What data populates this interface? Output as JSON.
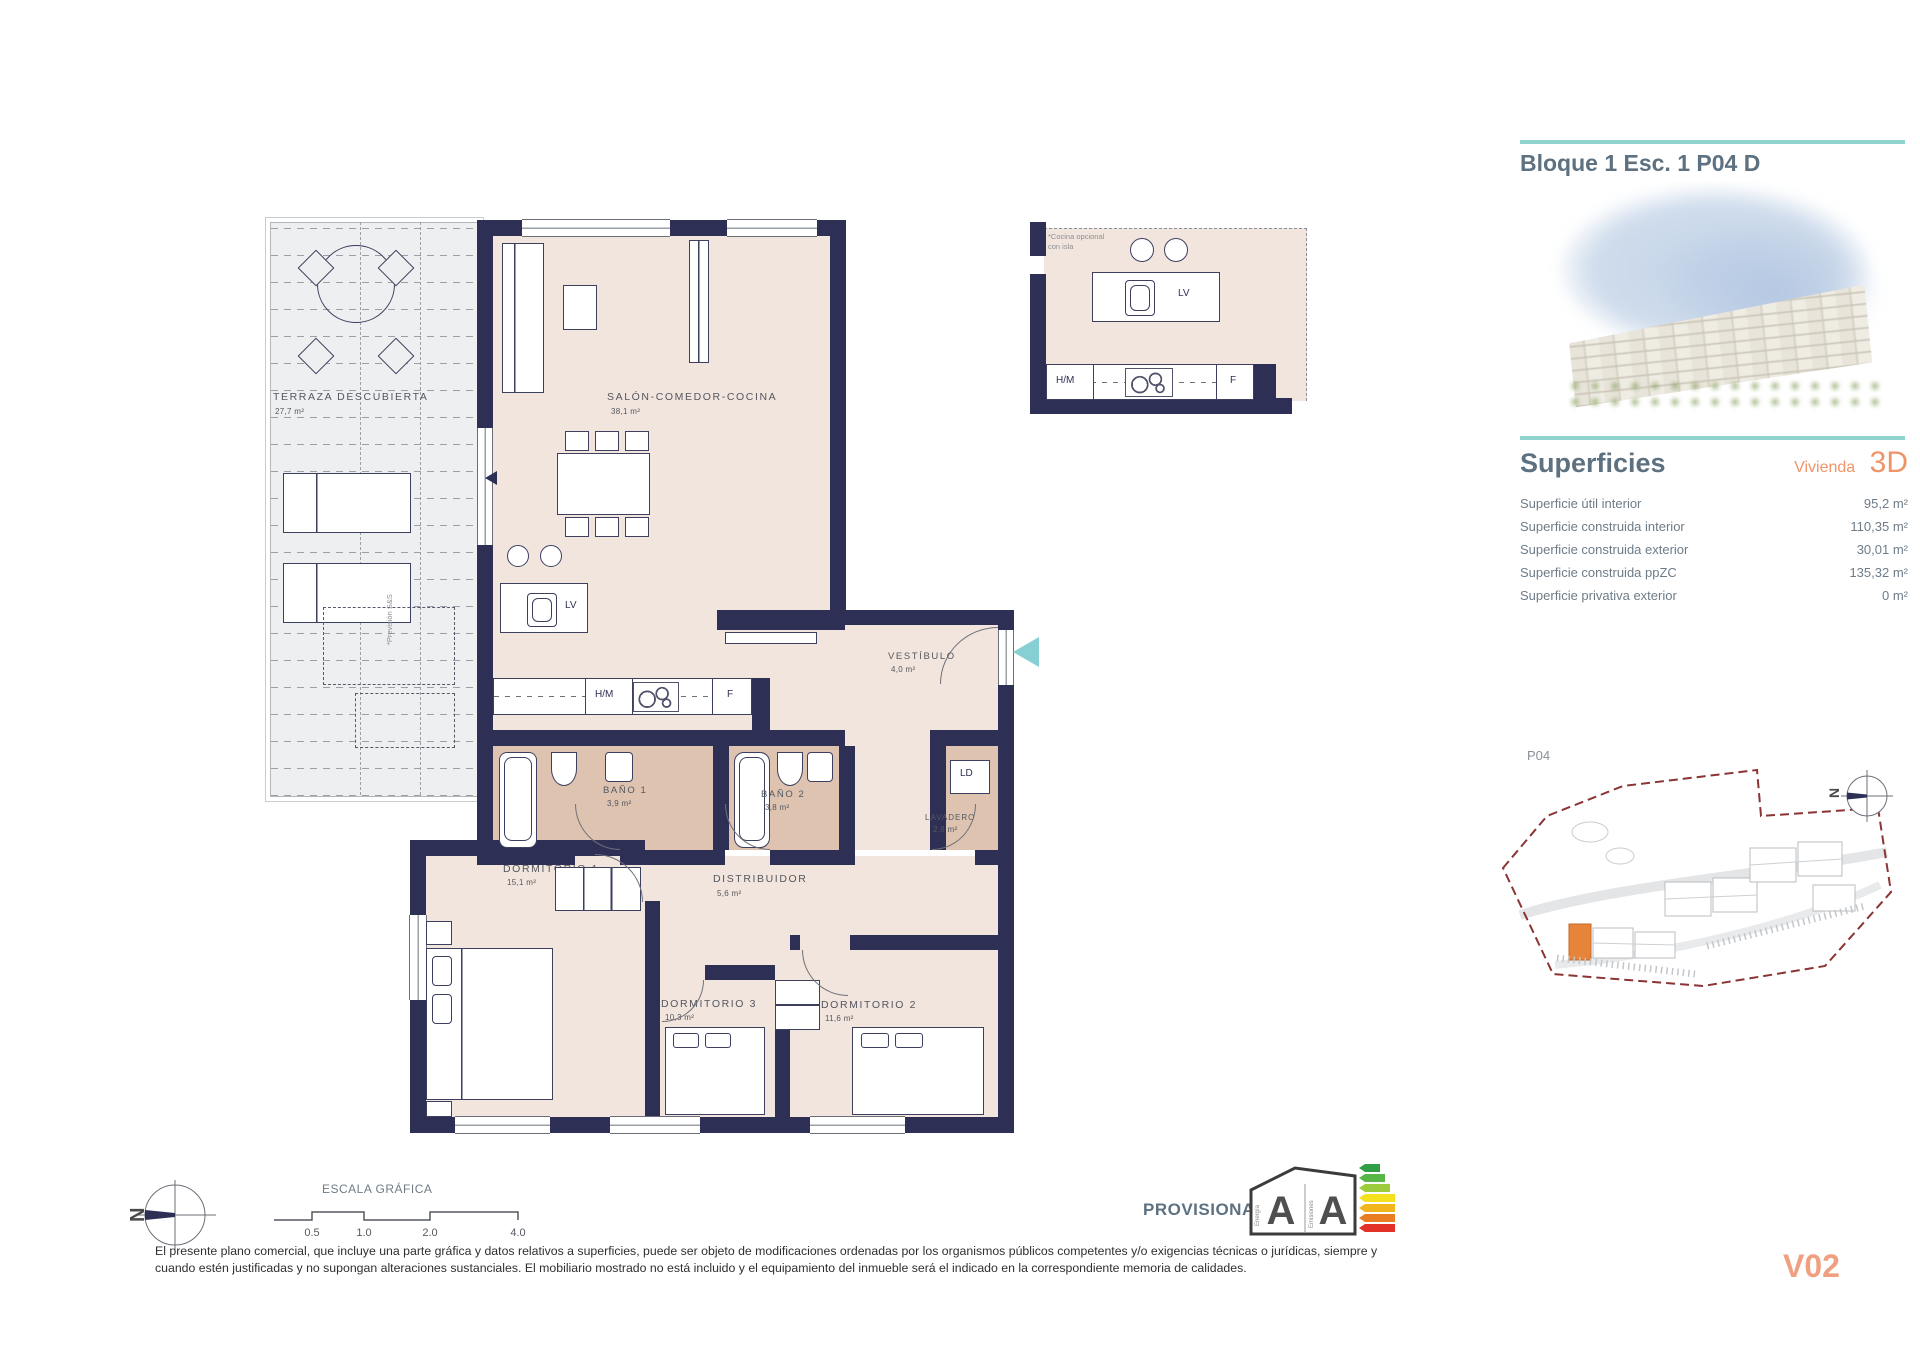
{
  "header": {
    "title": "Bloque 1 Esc. 1 P04 D"
  },
  "superficies": {
    "heading": "Superficies",
    "vivienda_label": "Vivienda",
    "unit_code": "3D",
    "rows": [
      {
        "label": "Superficie útil interior",
        "value": "95,2 m²"
      },
      {
        "label": "Superficie construida interior",
        "value": "110,35 m²"
      },
      {
        "label": "Superficie construida exterior",
        "value": "30,01 m²"
      },
      {
        "label": "Superficie construida ppZC",
        "value": "135,32 m²"
      },
      {
        "label": "Superficie privativa exterior",
        "value": "0 m²"
      }
    ]
  },
  "plan": {
    "rooms": [
      {
        "name": "TERRAZA DESCUBIERTA",
        "area": "27,7 m²"
      },
      {
        "name": "SALÓN-COMEDOR-COCINA",
        "area": "38,1 m²"
      },
      {
        "name": "VESTÍBULO",
        "area": "4,0 m²"
      },
      {
        "name": "BAÑO 1",
        "area": "3,9 m²"
      },
      {
        "name": "BAÑO 2",
        "area": "3,8 m²"
      },
      {
        "name": "DORMITORIO 1",
        "area": "15,1 m²"
      },
      {
        "name": "DISTRIBUIDOR",
        "area": "5,6 m²"
      },
      {
        "name": "LAVADERO",
        "area": "2,8 m²"
      },
      {
        "name": "DORMITORIO 3",
        "area": "10,3 m²"
      },
      {
        "name": "DORMITORIO 2",
        "area": "11,6 m²"
      }
    ],
    "fixtures": {
      "lv": "LV",
      "hm": "H/M",
      "f": "F",
      "ld": "LD"
    },
    "notes": {
      "kitchen_line1": "*Cocina opcional",
      "kitchen_line2": "con isla",
      "prevision": "*Previsión S&S"
    }
  },
  "site_plan": {
    "floor_label": "P04"
  },
  "compass": {
    "north": "N"
  },
  "scale_bar": {
    "title": "ESCALA GRÁFICA",
    "ticks": [
      "0.5",
      "1.0",
      "2.0",
      "4.0"
    ]
  },
  "energy": {
    "provisional": "PROVISIONAL",
    "energy_letter": "A",
    "emissions_letter": "A",
    "energy_label": "Energía",
    "emissions_label": "Emisiones"
  },
  "footer": {
    "disclaimer_line1": "El presente plano comercial, que incluye una parte gráfica y datos relativos a superficies, puede ser objeto de modificaciones ordenadas por los organismos públicos competentes y/o exigencias técnicas o jurídicas, siempre y",
    "disclaimer_line2": "cuando estén justificadas y no supongan alteraciones sustanciales. El mobiliario mostrado no está incluido y el equipamiento del inmueble será el indicado en la correspondiente memoria de calidades.",
    "version": "V02"
  },
  "colors": {
    "wall": "#2d3054",
    "floor": "#f2e5dd",
    "tile": "#ddc3b0",
    "teal": "#8fd4cf",
    "orange": "#ef9468",
    "boundary_red": "#8a3434"
  }
}
